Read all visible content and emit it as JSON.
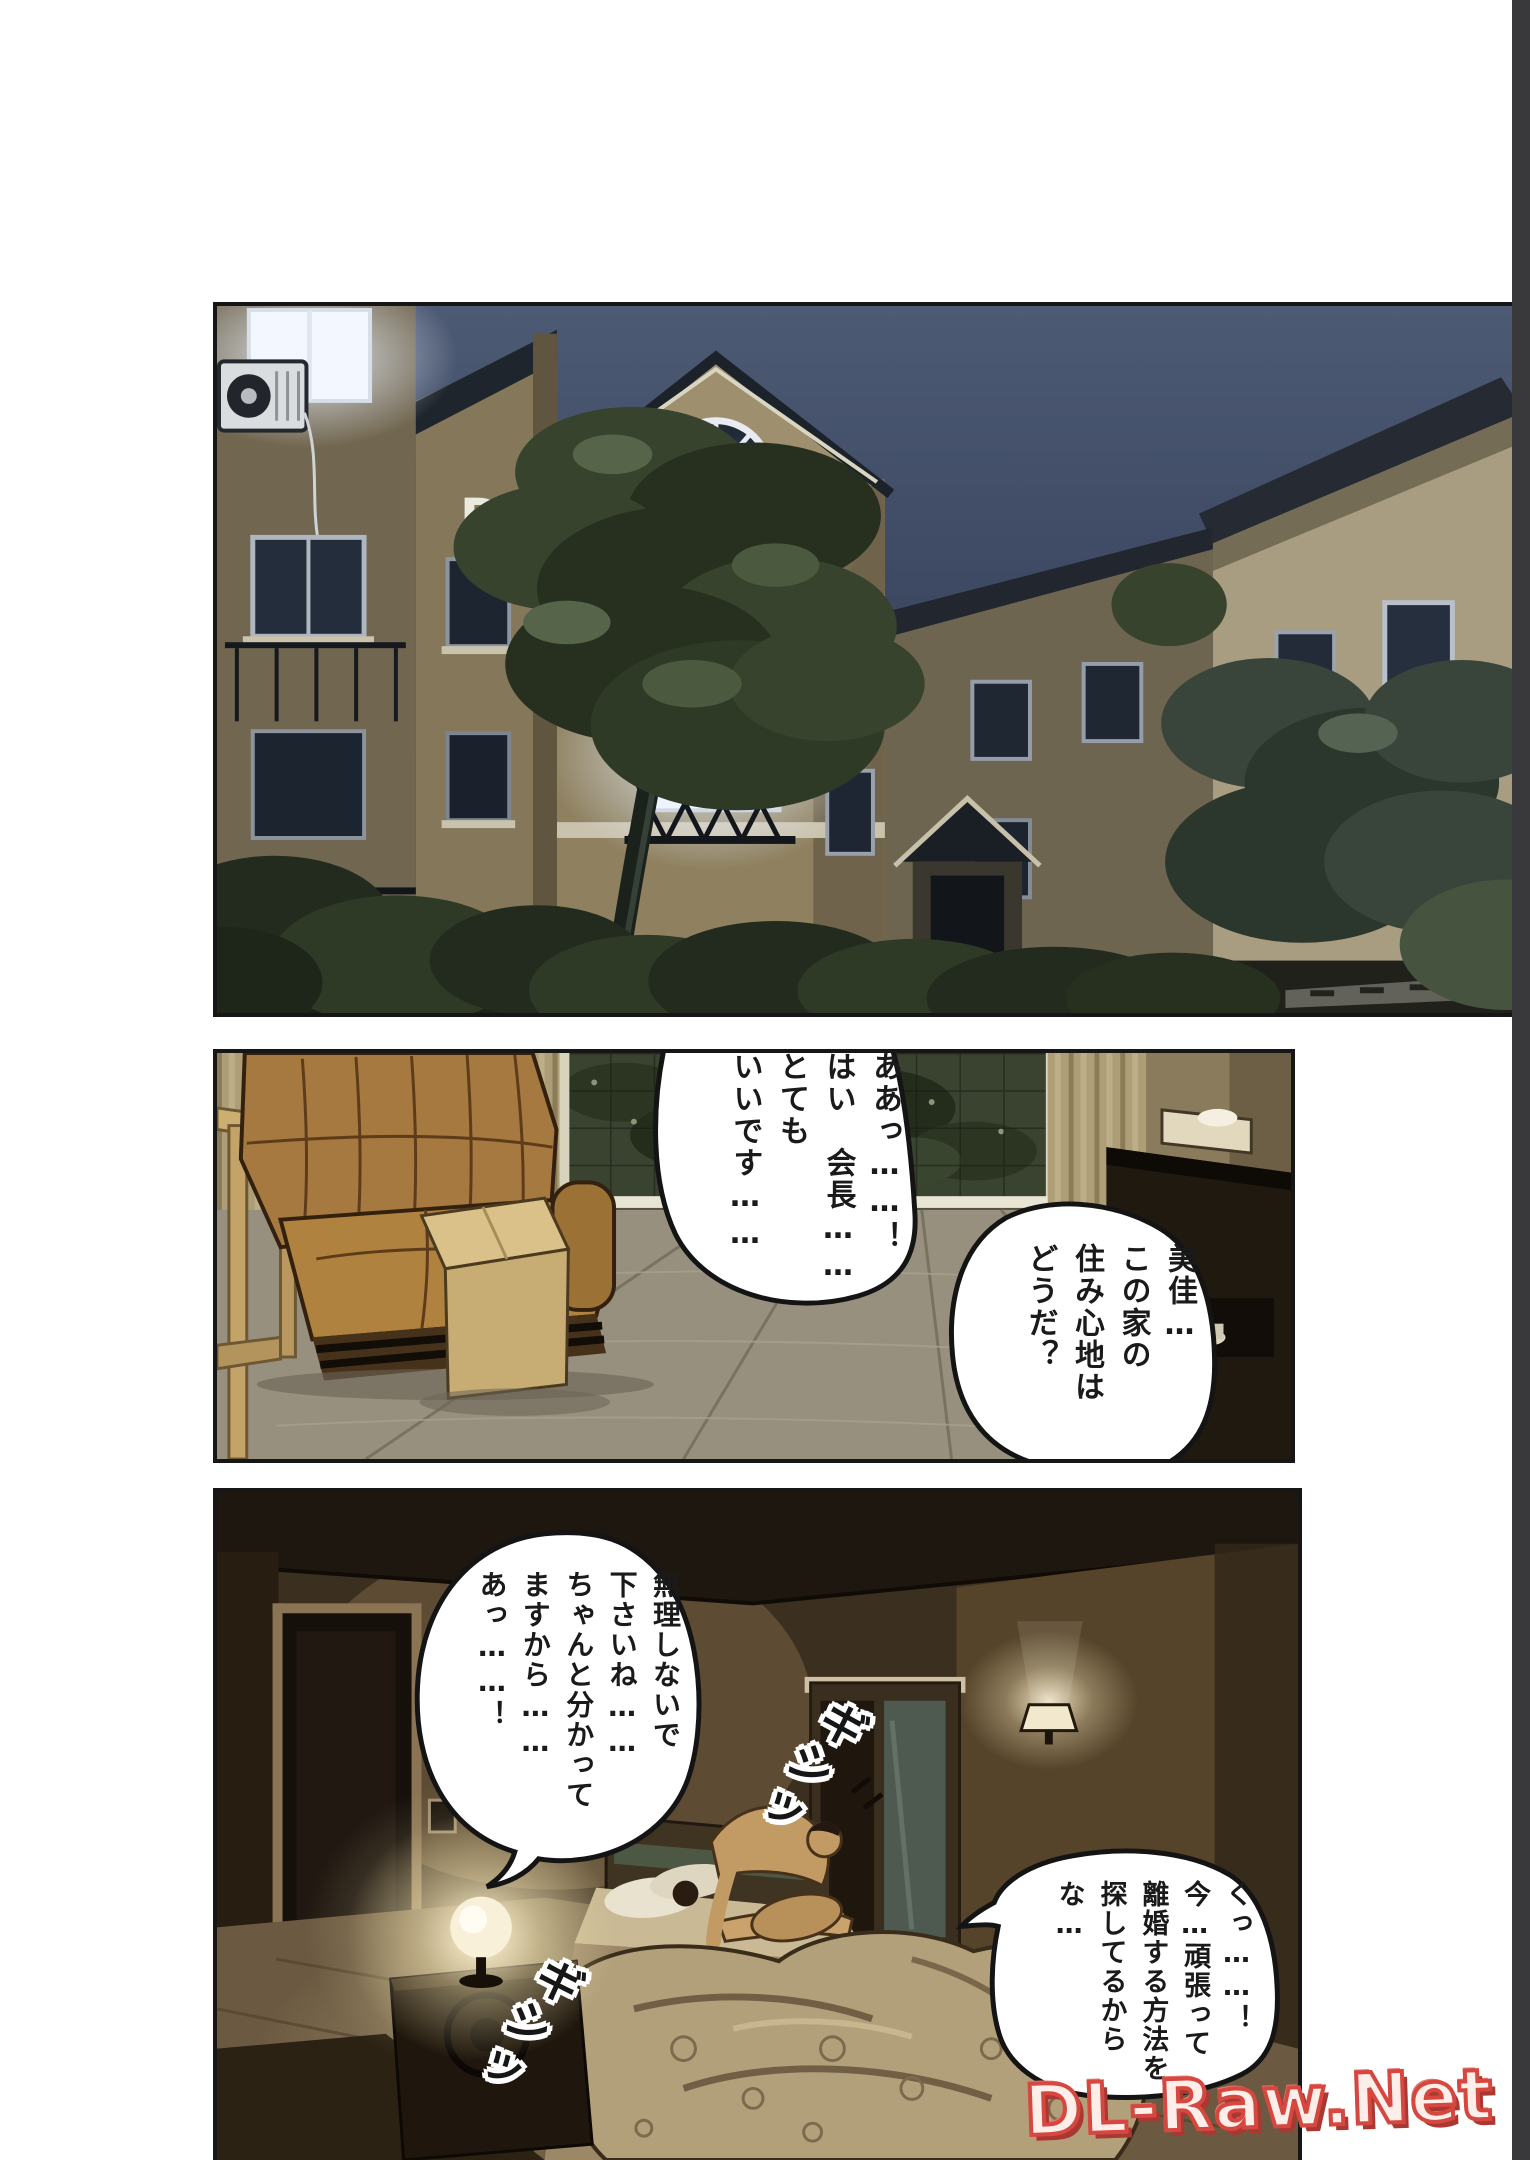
{
  "page": {
    "watermark_text": "DL-Raw.Net",
    "background_color": "#ffffff",
    "viewer_edge_color": "#39393b",
    "watermark_color": "#d5473f"
  },
  "panel1": {
    "building_label": "D"
  },
  "panel2": {
    "bubble_left": "ああっ……！\nはい　会長……\nとても\nいいです……",
    "bubble_right": "美佳…\nこの家の\n住み心地は\nどうだ？"
  },
  "panel3": {
    "bubble_top": "無理しないで\n下さいね……\nちゃんと分かって\nますから……\nあっ……！",
    "bubble_bottom": "くっ……！\n今…頑張って\n離婚する方法を\n探してるから\nな…",
    "sfx_upper": "ギシッ",
    "sfx_lower": "ギシッ"
  }
}
